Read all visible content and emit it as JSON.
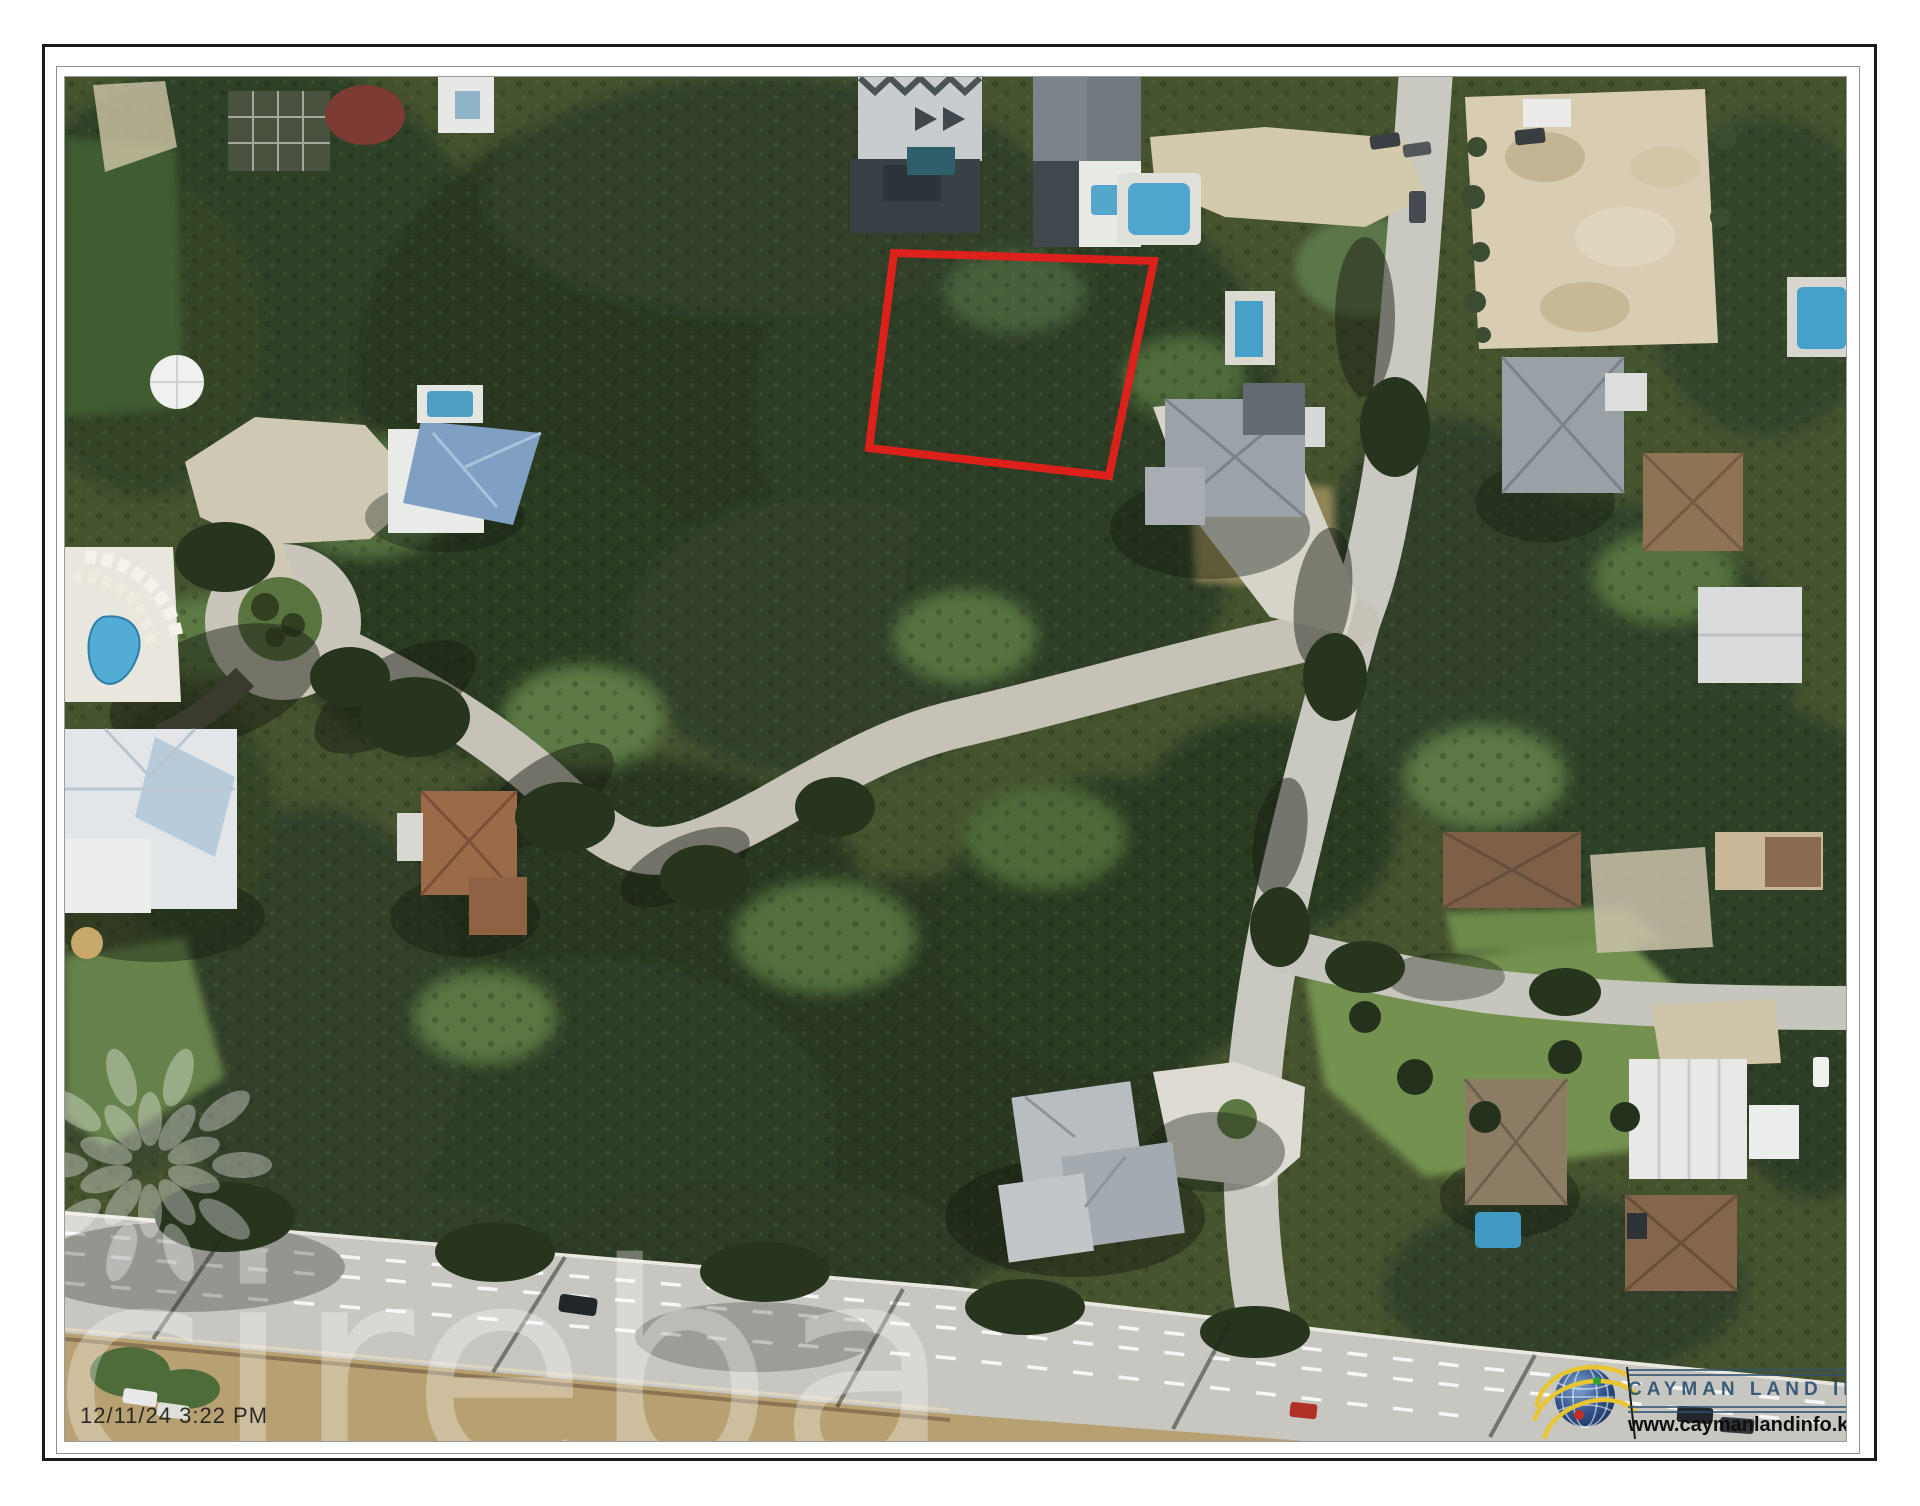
{
  "frame": {
    "outer_border": "#1a1a1a",
    "inner_border": "#8f8f8f",
    "background": "#ffffff"
  },
  "timestamp": {
    "text": "12/11/24 3:22 PM",
    "color": "#1d1d1d"
  },
  "watermark": {
    "text": "cireba",
    "color": "#ffffff",
    "opacity": 0.32
  },
  "parcel": {
    "points": "829,176 1089,184 1044,399 804,371",
    "color": "#e4201d",
    "stroke_width": 8
  },
  "logo": {
    "title": "CAYMAN LAND INFO",
    "url": "www.caymanlandinfo.ky",
    "title_color": "#2b4f72",
    "url_color": "#0e0e0e",
    "globe_blue": "#2e4f86",
    "swoosh_yellow": "#e8c631",
    "dot_green": "#2e9e3a",
    "dot_red": "#c22d28"
  }
}
